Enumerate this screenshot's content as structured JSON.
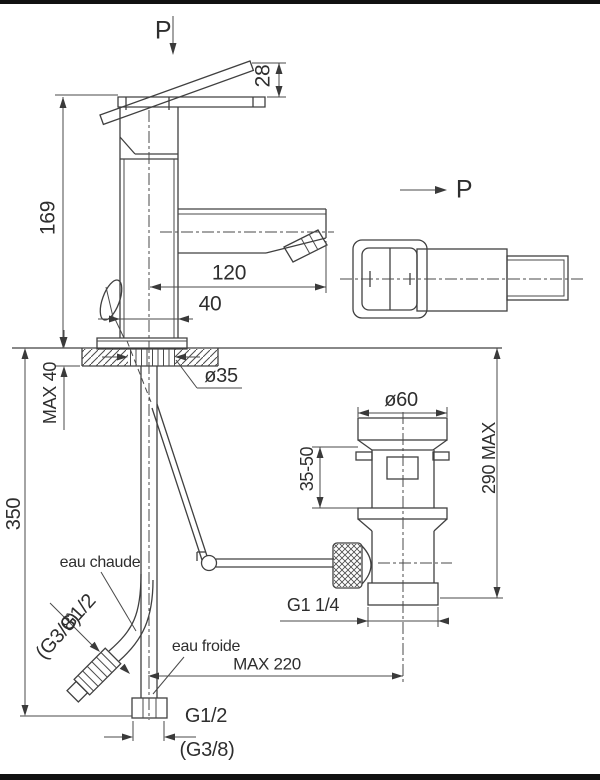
{
  "colors": {
    "line": "#404040",
    "text": "#2e2e2e",
    "background": "#ffffff",
    "border_bar": "#111111"
  },
  "labels": {
    "p_top": "P",
    "p_side": "P",
    "dim_28": "28",
    "dim_169": "169",
    "dim_120": "120",
    "dim_40": "40",
    "dim_max40": "MAX 40",
    "dia_35": "ø35",
    "dim_350": "350",
    "dia_60": "ø60",
    "dim_35_50": "35-50",
    "dim_290max": "290 MAX",
    "hot_label": "eau chaude",
    "cold_label": "eau froide",
    "hot_thread": "G1/2",
    "hot_thread_alt": "(G3/8)",
    "drain_thread": "G1 1/4",
    "dim_max220": "MAX 220",
    "cold_thread": "G1/2",
    "cold_thread_alt": "(G3/8)"
  }
}
